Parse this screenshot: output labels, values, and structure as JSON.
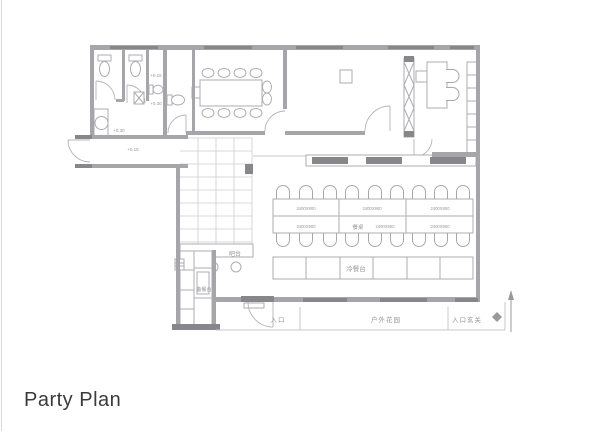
{
  "title": "Party Plan",
  "colors": {
    "wall": "#a6a6aa",
    "wall_dark": "#87878b",
    "furniture_line": "#aeaeb2",
    "label_text": "#96969a",
    "title_text": "#3a3a3a",
    "background": "#ffffff"
  },
  "plan": {
    "bathroom": {
      "level_upper": "+0.15",
      "level_lower": "+0.30",
      "washroom_level": "+0.30"
    },
    "corridor": {
      "level": "+0.15"
    },
    "bar": {
      "label": "吧台"
    },
    "kitchen": {
      "prep_label": "备餐台"
    },
    "dining": {
      "table_label": "餐桌",
      "table_size": "2400X900",
      "buffet_label": "冷餐台"
    },
    "outdoor": {
      "entrance": "入口",
      "garden": "户外花园",
      "foyer": "入口玄关"
    }
  }
}
